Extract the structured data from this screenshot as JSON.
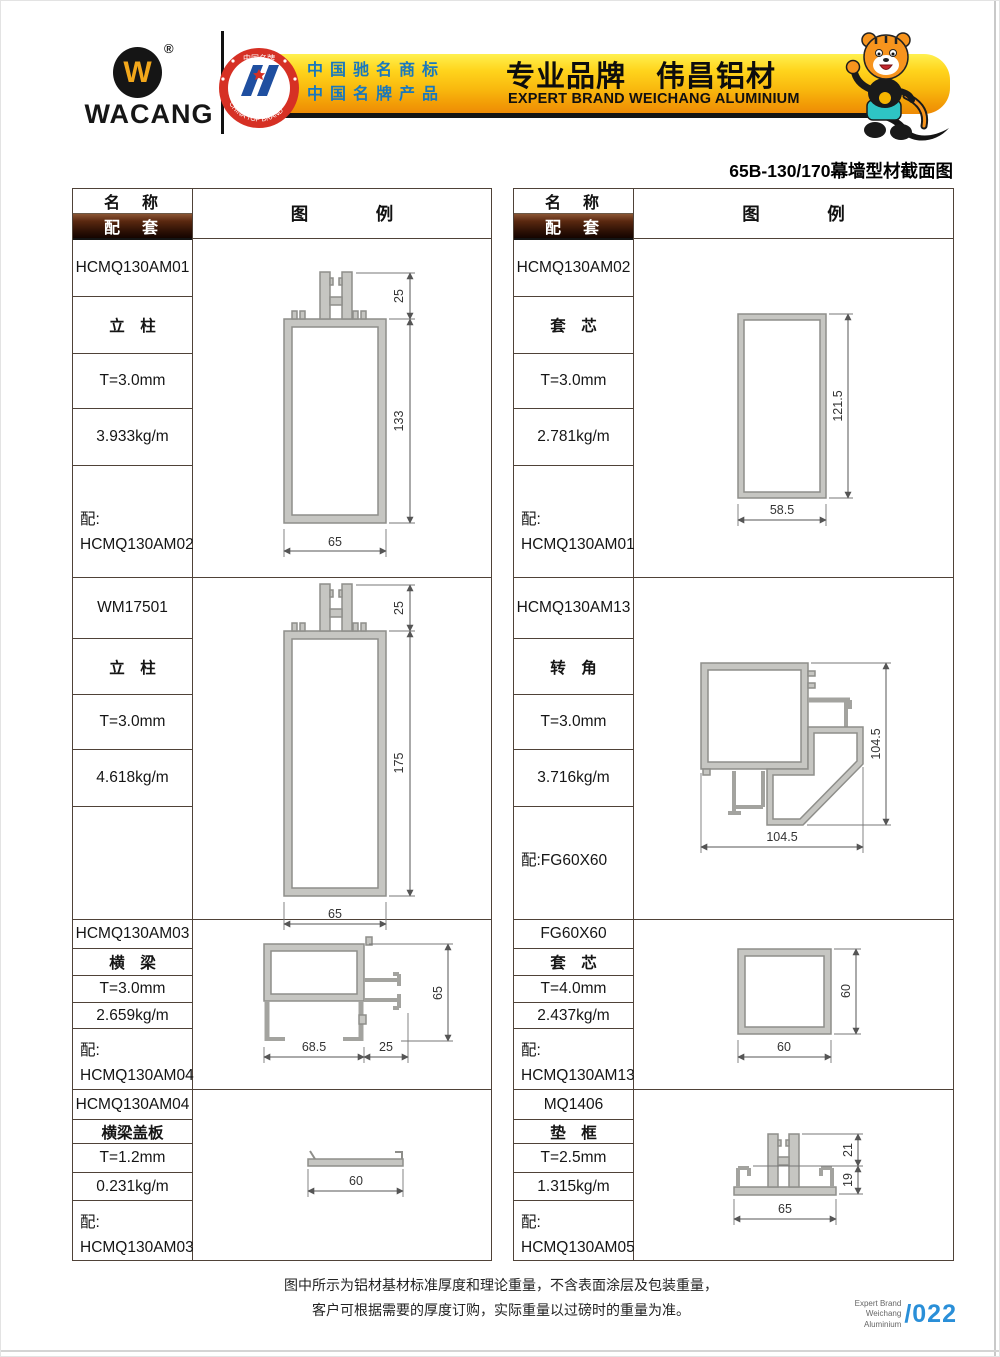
{
  "header": {
    "logo_word": "WACANG",
    "logo_glyph": "W",
    "reg_mark": "®",
    "badge_top": "中国名牌",
    "badge_bottom": "CHINA TOP BRAND",
    "claim1": "中国驰名商标",
    "claim2": "中国名牌产品",
    "brand_title": "专业品牌　伟昌铝材",
    "brand_subtitle": "EXPERT BRAND WEICHANG ALUMINIUM",
    "mascot_icon": "tiger-mascot"
  },
  "page_title": "65B-130/170幕墙型材截面图",
  "table": {
    "name_header": "名　称",
    "match_header": "配　套",
    "legend_header": "图　例"
  },
  "products": [
    {
      "code": "HCMQ130AM01",
      "type": "立　柱",
      "thickness": "T=3.0mm",
      "weight": "3.933kg/m",
      "match_label": "配:",
      "match_code": "HCMQ130AM02",
      "dims": {
        "fin": "25",
        "height": "133",
        "width": "65"
      }
    },
    {
      "code": "HCMQ130AM02",
      "type": "套　芯",
      "thickness": "T=3.0mm",
      "weight": "2.781kg/m",
      "match_label": "配:",
      "match_code": "HCMQ130AM01",
      "dims": {
        "height": "121.5",
        "width": "58.5"
      }
    },
    {
      "code": "WM17501",
      "type": "立　柱",
      "thickness": "T=3.0mm",
      "weight": "4.618kg/m",
      "match_label": "",
      "match_code": "",
      "dims": {
        "fin": "25",
        "height": "175",
        "width": "65"
      }
    },
    {
      "code": "HCMQ130AM13",
      "type": "转　角",
      "thickness": "T=3.0mm",
      "weight": "3.716kg/m",
      "match_label": "配:FG60X60",
      "match_code": "",
      "dims": {
        "height": "104.5",
        "width": "104.5"
      }
    },
    {
      "code": "HCMQ130AM03",
      "type": "横　梁",
      "thickness": "T=3.0mm",
      "weight": "2.659kg/m",
      "match_label": "配:",
      "match_code": "HCMQ130AM04",
      "dims": {
        "w1": "68.5",
        "w2": "25",
        "height": "65"
      }
    },
    {
      "code": "FG60X60",
      "type": "套　芯",
      "thickness": "T=4.0mm",
      "weight": "2.437kg/m",
      "match_label": "配:",
      "match_code": "HCMQ130AM13",
      "dims": {
        "height": "60",
        "width": "60"
      }
    },
    {
      "code": "HCMQ130AM04",
      "type": "横梁盖板",
      "thickness": "T=1.2mm",
      "weight": "0.231kg/m",
      "match_label": "配:",
      "match_code": "HCMQ130AM03",
      "dims": {
        "width": "60"
      }
    },
    {
      "code": "MQ1406",
      "type": "垫　框",
      "thickness": "T=2.5mm",
      "weight": "1.315kg/m",
      "match_label": "配:",
      "match_code": "HCMQ130AM05",
      "dims": {
        "h1": "21",
        "h2": "19",
        "width": "65"
      }
    }
  ],
  "footer": {
    "note1": "图中所示为铝材基材标准厚度和理论重量，不含表面涂层及包装重量，",
    "note2": "客户可根据需要的厚度订购，实际重量以过磅时的重量为准。",
    "brand_line1": "Expert Brand",
    "brand_line2": "Weichang Aluminium",
    "page_number": "/022"
  },
  "colors": {
    "banner_gold": "#F9B90E",
    "badge_red": "#D63024",
    "claim_blue": "#1878BE",
    "page_number_blue": "#2A8FD8",
    "header_bar_brown": "#2A0F04",
    "profile_gray": "#C6C6C2"
  }
}
